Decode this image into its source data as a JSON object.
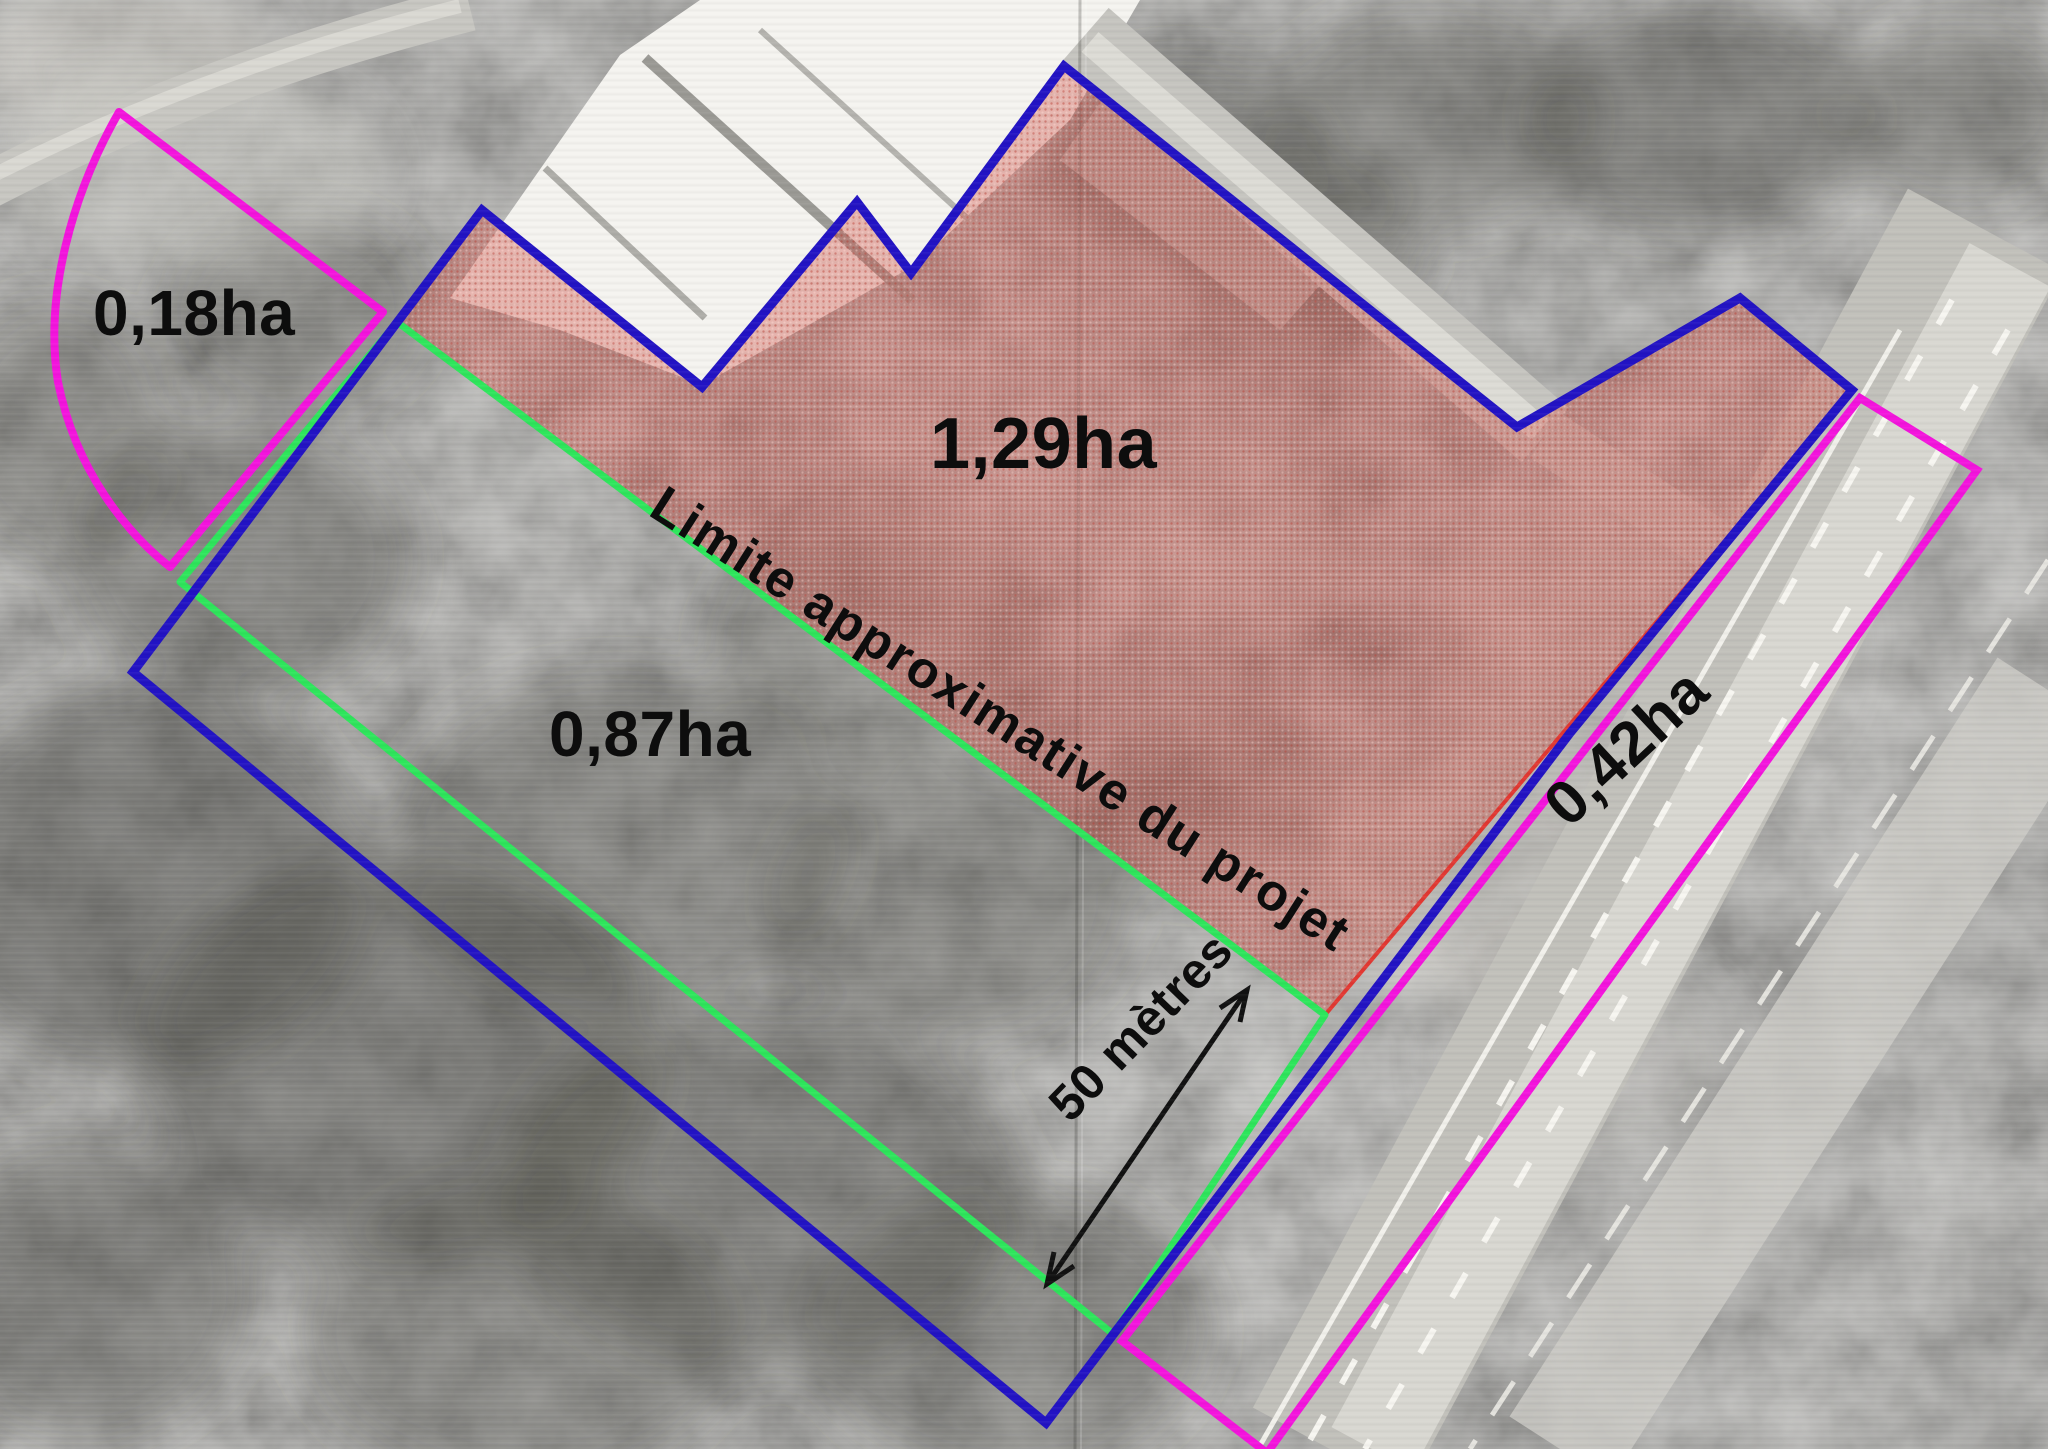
{
  "parcels": [
    {
      "id": "fan-parcel-northwest",
      "area_label": "0,18ha",
      "outline_color": "#f414dd"
    },
    {
      "id": "project-area",
      "area_label": "1,29ha",
      "outline_color": "#2213c4",
      "fill_color": "#d0584c"
    },
    {
      "id": "buffer-strip",
      "area_label": "0,87ha",
      "outline_color": "#2ee65c"
    },
    {
      "id": "roadside-parcel-southeast",
      "area_label": "0,42ha",
      "outline_color": "#f414dd"
    }
  ],
  "annotations": {
    "project_limit_label": "Limite approximative du projet",
    "scale_label": "50 mètres"
  },
  "colors": {
    "site_boundary_blue": "#2213c4",
    "parcel_magenta": "#f414dd",
    "project_limit_green": "#2ee65c",
    "project_area_red_line": "#e23832",
    "label_text": "#0d0d0d"
  }
}
